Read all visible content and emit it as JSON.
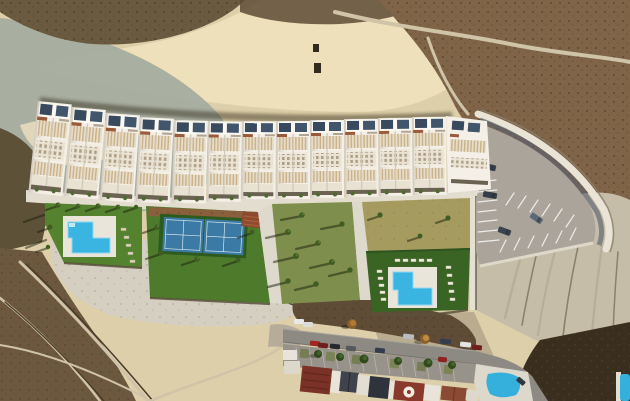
{
  "image": {
    "kind": "aerial-photograph",
    "subject": "New-build terraced housing development with communal gardens, two L-shaped pools, padel courts and a curved parking terrace on an arid badlands hillside above an existing residential street",
    "width": 630,
    "height": 401
  },
  "colors": {
    "terrain_sand": "#ddcfa9",
    "terrain_sand_bright": "#eee0ba",
    "terrain_teal": "#a3ab9f",
    "terrain_scrub": "#7f6448",
    "terrain_wash": "#d5cfc1",
    "terrain_slope": "#c6bda9",
    "terrain_dark_corner": "#3a2e1f",
    "building_white": "#f4f0e7",
    "solar_panel": "#394a5e",
    "pergola": "#d9c3a1",
    "terracotta_accent": "#9b5a39",
    "walkway": "#e3ddcf",
    "lawn_left": "#55822e",
    "lawn_tennis": "#4e7a2c",
    "lawn_center": "#7e8f4d",
    "lawn_right_dry": "#a59b5f",
    "lawn_right": "#3a6424",
    "court_blue": "#3a7aa4",
    "mulch": "#8a5f3c",
    "pool_water": "#3ab4e0",
    "pool_deck": "#e9e5da",
    "asphalt": "#aaa49a",
    "road": "#8d8a84",
    "roof_red": "#7a3226",
    "roof_slate": "#3f434c",
    "roof_navy": "#2f333c",
    "roof_terracotta": "#8a4a33",
    "tree_green": "#2f4a1c",
    "tree_autumn": "#b07a36",
    "existing_pool": "#35b0dd"
  },
  "scene": {
    "features": [
      {
        "name": "badlands-terrain",
        "label": "Arid badlands hillside with trails"
      },
      {
        "name": "townhouse-row",
        "label": "Row of 12 white townhouse blocks with rooftop solar panels and pergolas"
      },
      {
        "name": "left-garden-pool",
        "label": "L-shaped communal pool on lawn with sun loungers"
      },
      {
        "name": "padel-courts",
        "label": "Two blue padel courts on lawn"
      },
      {
        "name": "center-palm-garden",
        "label": "Palm garden with long shadows"
      },
      {
        "name": "right-garden-pool",
        "label": "L-shaped communal pool surrounded by sun loungers"
      },
      {
        "name": "parking-terrace",
        "label": "Curved retaining wall parking area with marked bays and cars"
      },
      {
        "name": "existing-street",
        "label": "Existing street with parked cars, trees and houses"
      },
      {
        "name": "existing-pool",
        "label": "Existing residential pool"
      }
    ]
  }
}
